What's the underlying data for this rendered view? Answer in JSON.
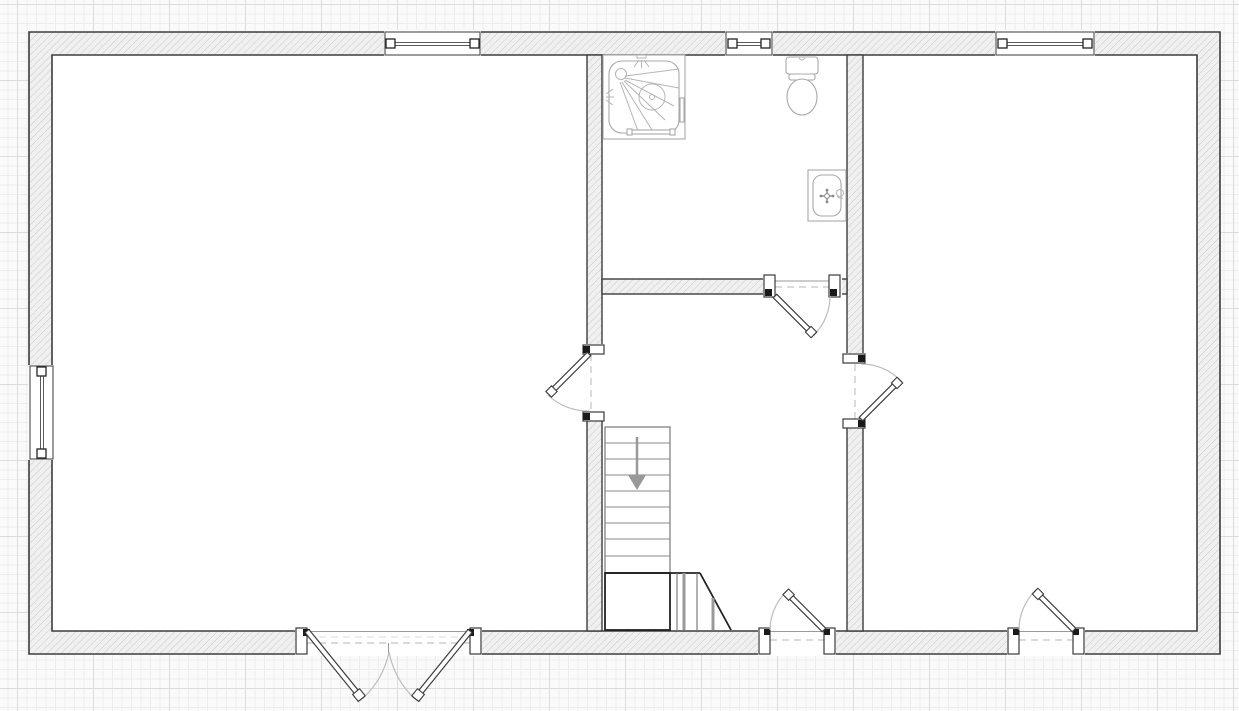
{
  "canvas": {
    "type": "floor-plan-drawing-canvas",
    "background": "#fafafa",
    "grid": {
      "minor_step_px": 9.5,
      "major_step_px": 76,
      "minor_color": "#ededed",
      "major_color": "#dcdcdc"
    }
  },
  "palette": {
    "room_fill": "#ffffff",
    "wall_fill": "#f0f0f0",
    "wall_hatch": "#c9c9c9",
    "wall_outline": "#3d3d3d",
    "swing_arc": "#bdbdbd",
    "opening_dash": "#c4c4c4",
    "fixture_stroke": "#a8a8a8",
    "stair_bold": "#222222",
    "arrow_gray": "#999999"
  },
  "floor_plan": {
    "exterior_walls": "hatched cavity-wall rectangle",
    "rooms": [
      {
        "id": "left-room"
      },
      {
        "id": "bathroom"
      },
      {
        "id": "hall-with-stairs"
      },
      {
        "id": "right-room"
      }
    ],
    "windows": [
      {
        "id": "window-north-left-room",
        "wall": "north"
      },
      {
        "id": "window-north-bathroom",
        "wall": "north"
      },
      {
        "id": "window-north-right-room",
        "wall": "north"
      },
      {
        "id": "window-west-left-room",
        "wall": "west"
      }
    ],
    "doors": [
      {
        "id": "double-door-left-room",
        "type": "double-leaf-swing-out",
        "wall": "south"
      },
      {
        "id": "entry-door-hall",
        "type": "single-swing-in",
        "wall": "south"
      },
      {
        "id": "entry-door-right-room",
        "type": "single-swing-in",
        "wall": "south"
      },
      {
        "id": "door-left-room-to-hall",
        "type": "single",
        "wall": "interior"
      },
      {
        "id": "door-hall-to-right-room",
        "type": "single",
        "wall": "interior"
      },
      {
        "id": "door-bathroom-to-hall",
        "type": "single",
        "wall": "interior"
      }
    ],
    "fixtures": [
      {
        "id": "shower-icon",
        "room": "bathroom"
      },
      {
        "id": "toilet-icon",
        "room": "bathroom"
      },
      {
        "id": "sink-icon",
        "room": "bathroom"
      },
      {
        "id": "stairs-down-icon",
        "room": "hall-with-stairs",
        "treads": 9,
        "arrow": "down"
      }
    ]
  }
}
